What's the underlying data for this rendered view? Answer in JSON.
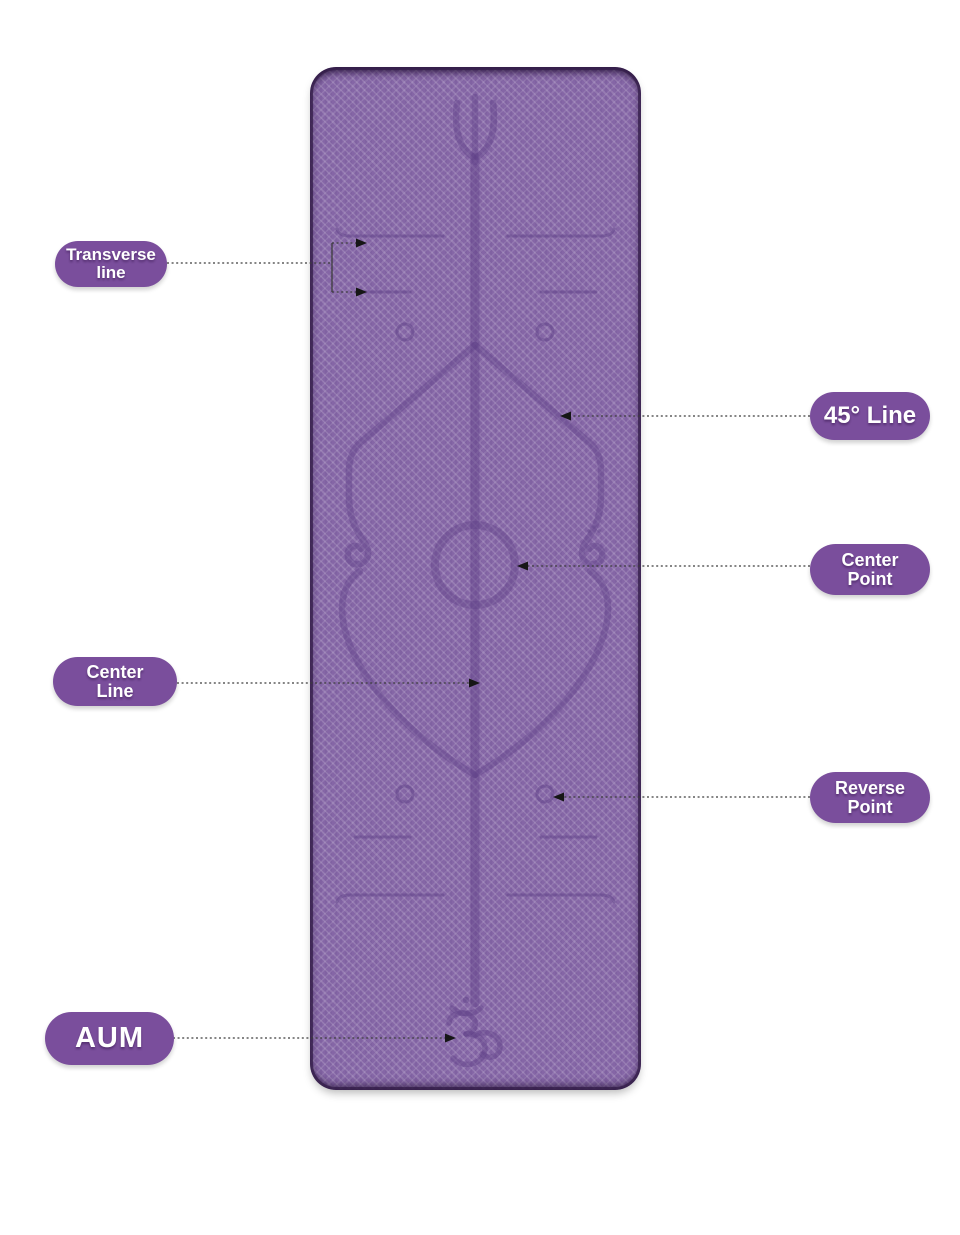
{
  "colors": {
    "page_bg": "#ffffff",
    "mat_base": "#8566a6",
    "mat_edge": "#3f2a57",
    "etch": "#5f4187",
    "label_bg": "#7a4e9c",
    "label_text": "#ffffff",
    "callout": "#3c3c3c"
  },
  "labels": [
    {
      "id": "transverse-line",
      "lines": [
        "Transverse",
        "line"
      ]
    },
    {
      "id": "45-line",
      "lines": [
        "45° Line"
      ]
    },
    {
      "id": "center-point",
      "lines": [
        "Center",
        "Point"
      ]
    },
    {
      "id": "center-line",
      "lines": [
        "Center",
        "Line"
      ]
    },
    {
      "id": "reverse-point",
      "lines": [
        "Reverse",
        "Point"
      ]
    },
    {
      "id": "aum",
      "lines": [
        "AUM"
      ]
    }
  ],
  "mat": {
    "symbols": {
      "top": "trident-icon",
      "bottom": "om-icon"
    },
    "features": [
      "transverse-lines",
      "45-degree-lines",
      "center-point-circle",
      "center-line",
      "reverse-point-circles",
      "guide-circles",
      "alignment-diamond"
    ]
  }
}
